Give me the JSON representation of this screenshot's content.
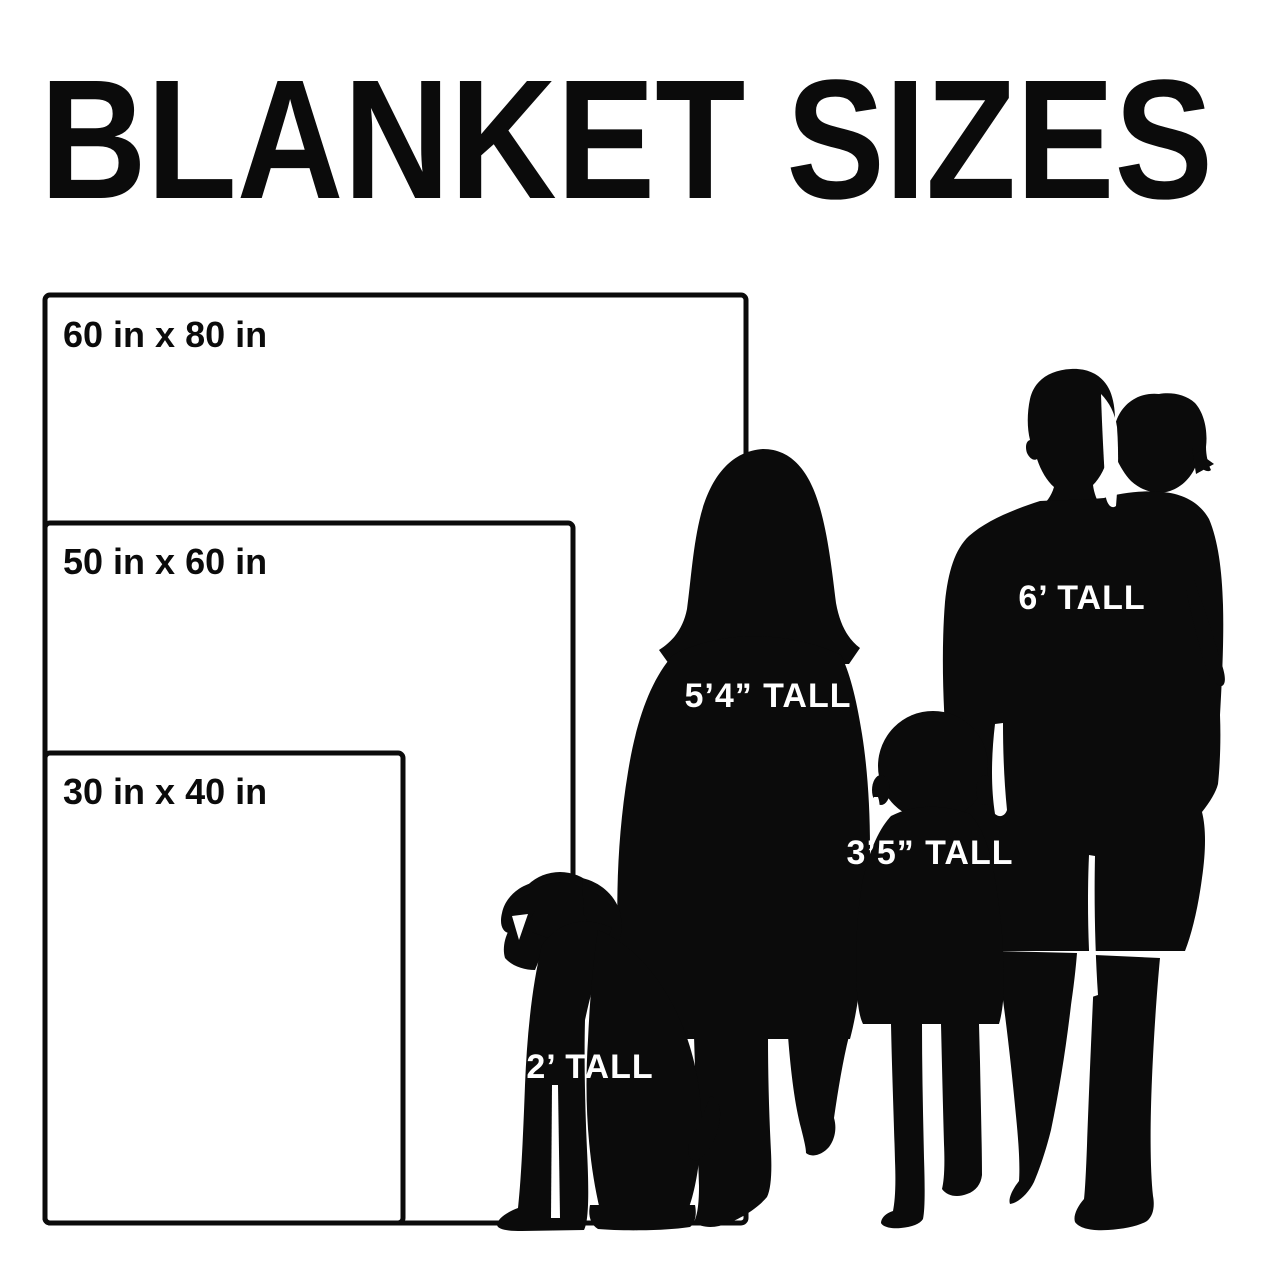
{
  "title": "BLANKET SIZES",
  "colors": {
    "ink": "#0b0b0b",
    "background": "#ffffff",
    "label_on_dark": "#ffffff"
  },
  "blankets": [
    {
      "label": "60 in x 80 in",
      "width_in": 60,
      "height_in": 80
    },
    {
      "label": "50 in x 60 in",
      "width_in": 50,
      "height_in": 60
    },
    {
      "label": "30 in x 40 in",
      "width_in": 30,
      "height_in": 40
    }
  ],
  "figures": [
    {
      "name": "adult-woman",
      "label": "5’4” TALL"
    },
    {
      "name": "adult-man-holding-toddler",
      "label": "6’ TALL"
    },
    {
      "name": "child",
      "label": "3’5” TALL"
    },
    {
      "name": "dog",
      "label": "2’ TALL"
    }
  ]
}
